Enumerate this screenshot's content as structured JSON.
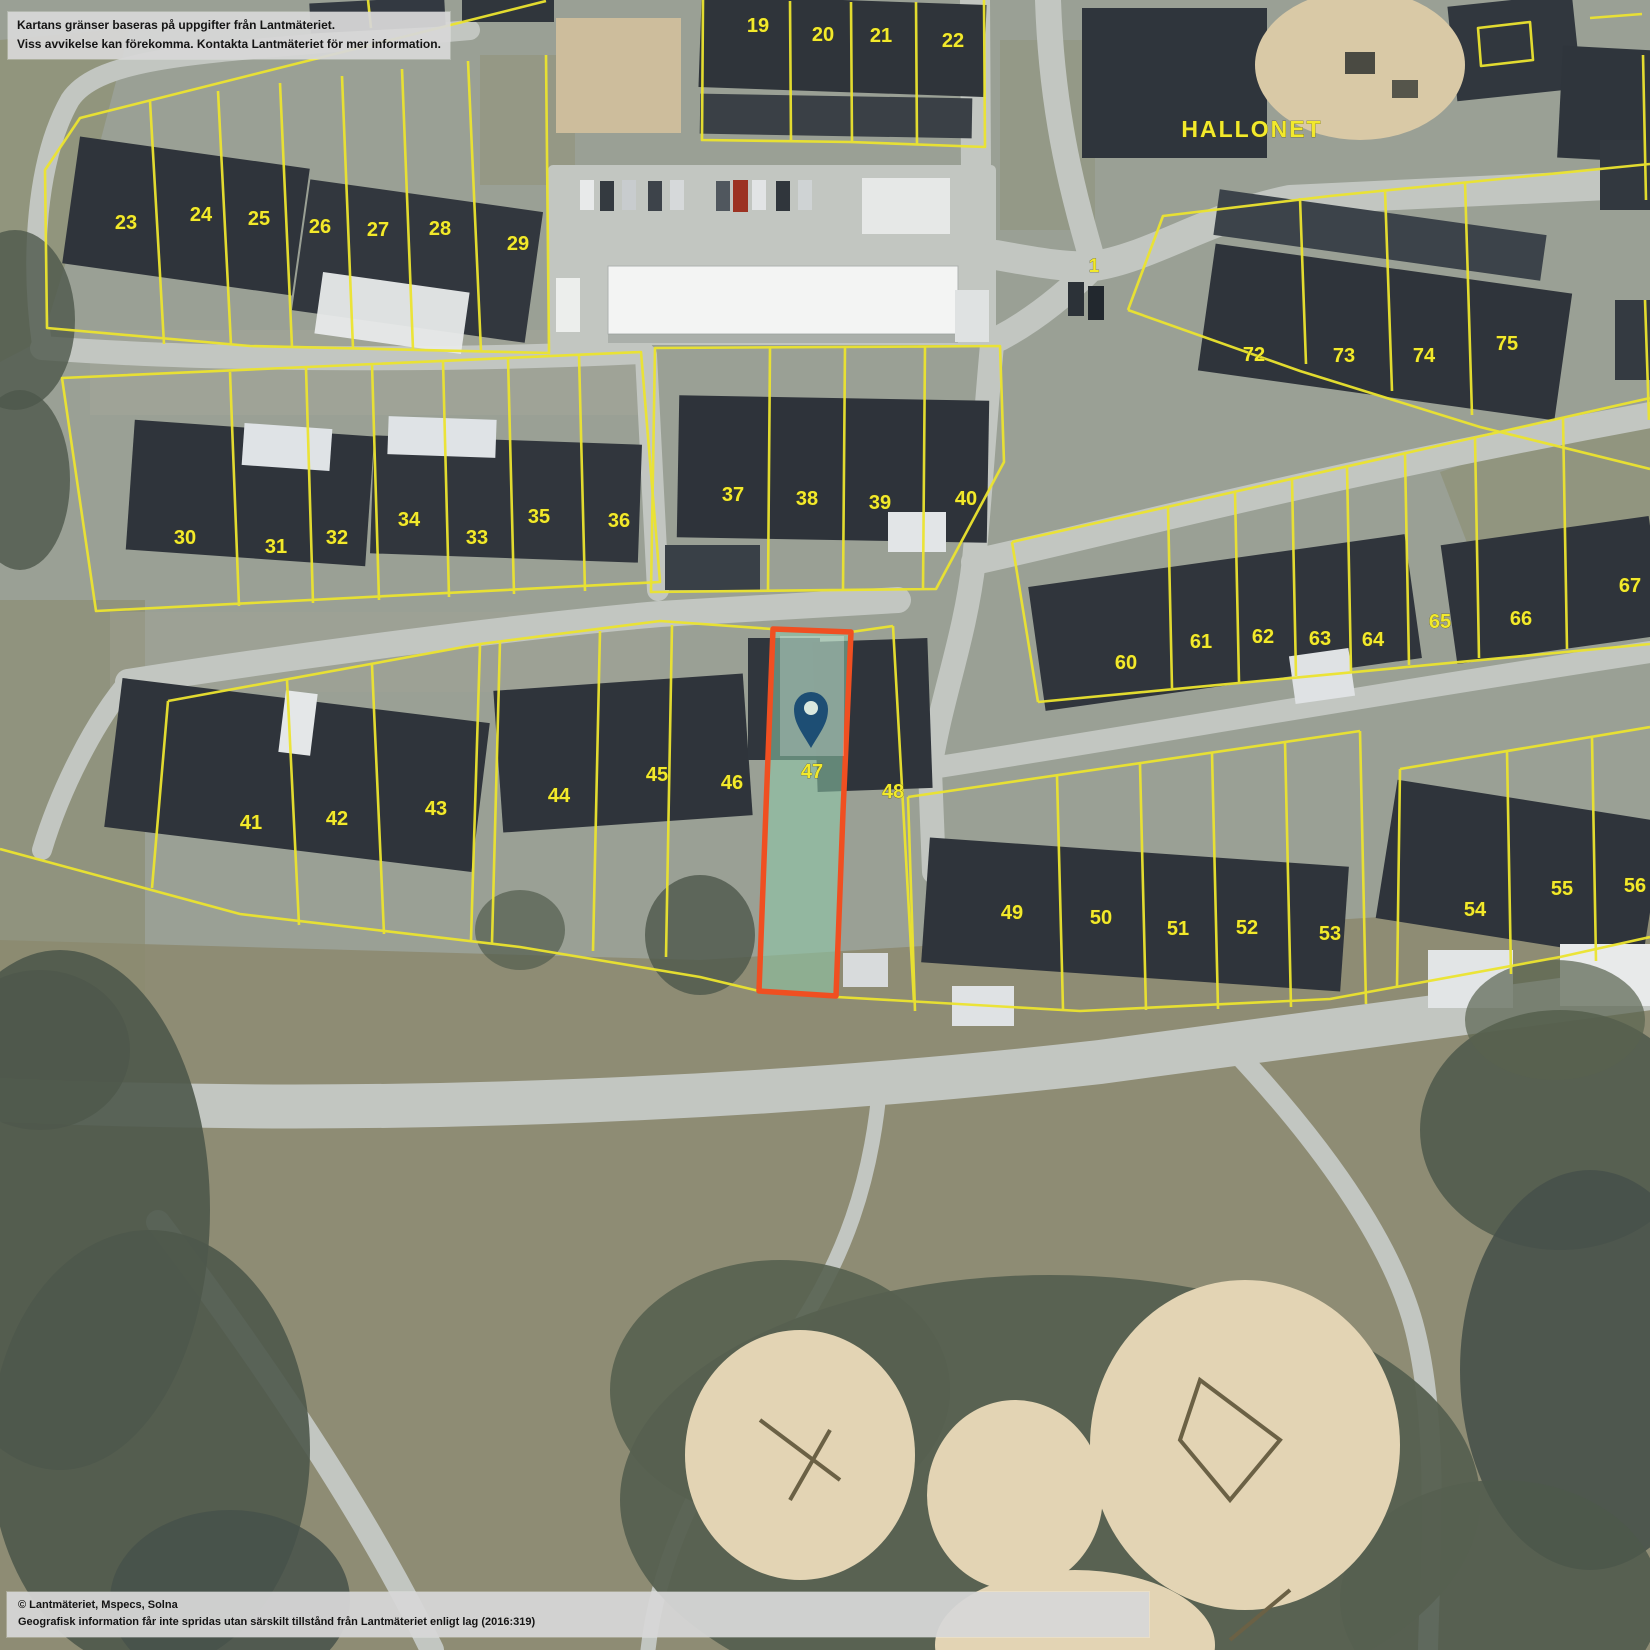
{
  "map": {
    "labels": [
      {
        "t": "19",
        "x": 758,
        "y": 32
      },
      {
        "t": "20",
        "x": 823,
        "y": 41
      },
      {
        "t": "21",
        "x": 881,
        "y": 42
      },
      {
        "t": "22",
        "x": 953,
        "y": 47
      },
      {
        "t": "23",
        "x": 126,
        "y": 229
      },
      {
        "t": "24",
        "x": 201,
        "y": 221
      },
      {
        "t": "25",
        "x": 259,
        "y": 225
      },
      {
        "t": "26",
        "x": 320,
        "y": 233
      },
      {
        "t": "27",
        "x": 378,
        "y": 236
      },
      {
        "t": "28",
        "x": 440,
        "y": 235
      },
      {
        "t": "29",
        "x": 518,
        "y": 250
      },
      {
        "t": "30",
        "x": 185,
        "y": 544
      },
      {
        "t": "31",
        "x": 276,
        "y": 553
      },
      {
        "t": "32",
        "x": 337,
        "y": 544
      },
      {
        "t": "34",
        "x": 409,
        "y": 526
      },
      {
        "t": "33",
        "x": 477,
        "y": 544
      },
      {
        "t": "35",
        "x": 539,
        "y": 523
      },
      {
        "t": "36",
        "x": 619,
        "y": 527
      },
      {
        "t": "37",
        "x": 733,
        "y": 501
      },
      {
        "t": "38",
        "x": 807,
        "y": 505
      },
      {
        "t": "39",
        "x": 880,
        "y": 509
      },
      {
        "t": "40",
        "x": 966,
        "y": 505
      },
      {
        "t": "41",
        "x": 251,
        "y": 829
      },
      {
        "t": "42",
        "x": 337,
        "y": 825
      },
      {
        "t": "43",
        "x": 436,
        "y": 815
      },
      {
        "t": "44",
        "x": 559,
        "y": 802
      },
      {
        "t": "45",
        "x": 657,
        "y": 781
      },
      {
        "t": "46",
        "x": 732,
        "y": 789
      },
      {
        "t": "47",
        "x": 812,
        "y": 778
      },
      {
        "t": "48",
        "x": 893,
        "y": 798
      },
      {
        "t": "49",
        "x": 1012,
        "y": 919
      },
      {
        "t": "50",
        "x": 1101,
        "y": 924
      },
      {
        "t": "51",
        "x": 1178,
        "y": 935
      },
      {
        "t": "52",
        "x": 1247,
        "y": 934
      },
      {
        "t": "53",
        "x": 1330,
        "y": 940
      },
      {
        "t": "54",
        "x": 1475,
        "y": 916
      },
      {
        "t": "55",
        "x": 1562,
        "y": 895
      },
      {
        "t": "56",
        "x": 1635,
        "y": 892
      },
      {
        "t": "60",
        "x": 1126,
        "y": 669
      },
      {
        "t": "61",
        "x": 1201,
        "y": 648
      },
      {
        "t": "62",
        "x": 1263,
        "y": 643
      },
      {
        "t": "63",
        "x": 1320,
        "y": 645
      },
      {
        "t": "64",
        "x": 1373,
        "y": 646
      },
      {
        "t": "65",
        "x": 1440,
        "y": 628
      },
      {
        "t": "66",
        "x": 1521,
        "y": 625
      },
      {
        "t": "67",
        "x": 1630,
        "y": 592
      },
      {
        "t": "72",
        "x": 1254,
        "y": 361
      },
      {
        "t": "73",
        "x": 1344,
        "y": 362
      },
      {
        "t": "74",
        "x": 1424,
        "y": 362
      },
      {
        "t": "75",
        "x": 1507,
        "y": 350
      },
      {
        "t": "1",
        "x": 1094,
        "y": 272,
        "kind": "road"
      },
      {
        "t": "HALLONET",
        "x": 1252,
        "y": 137,
        "kind": "place"
      }
    ],
    "highlighted_parcel": {
      "number": "47"
    },
    "pin": {
      "x": 811,
      "y": 748
    }
  },
  "colors": {
    "boundary_yellow": "#ece42f",
    "label_yellow": "#f2e92c",
    "highlight_fill": "#8ecbaa",
    "highlight_border": "#f04f21",
    "pin_blue": "#1d4e74",
    "pin_hole": "#d9e8df"
  },
  "overlays": {
    "disclaimer": {
      "line1": "Kartans gränser baseras på uppgifter från Lantmäteriet.",
      "line2": "Viss avvikelse kan förekomma. Kontakta Lantmäteriet för mer information."
    },
    "attribution": {
      "line1": "© Lantmäteriet, Mspecs, Solna",
      "line2": "Geografisk information får inte spridas utan särskilt tillstånd från Lantmäteriet enligt lag (2016:319)"
    }
  }
}
